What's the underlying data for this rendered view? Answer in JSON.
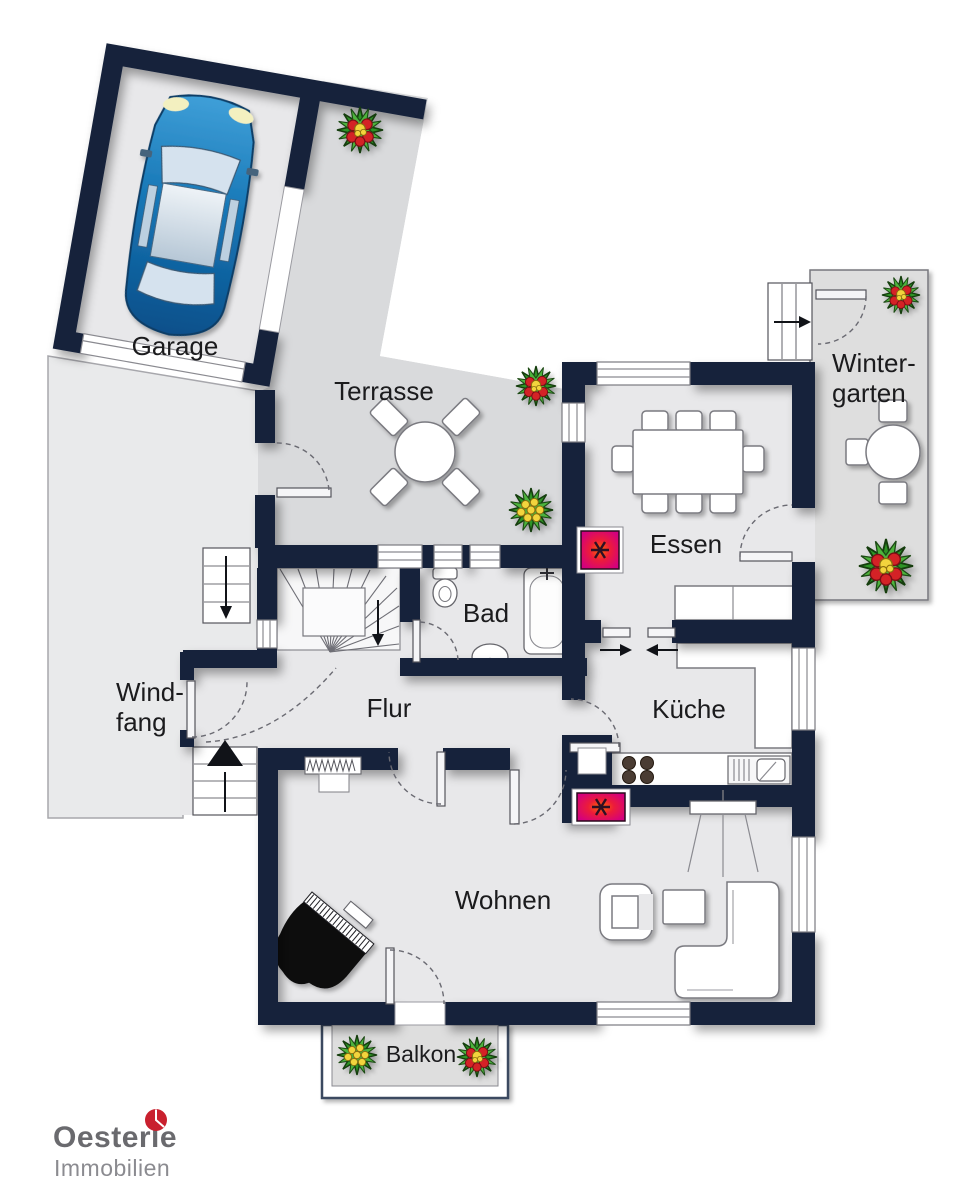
{
  "document": {
    "kind": "real-estate floor plan",
    "width_px": 968,
    "height_px": 1200
  },
  "rooms": [
    {
      "id": "garage",
      "label": "Garage"
    },
    {
      "id": "terrasse",
      "label": "Terrasse"
    },
    {
      "id": "wintergarten",
      "label_line1": "Winter-",
      "label_line2": "garten"
    },
    {
      "id": "essen",
      "label": "Essen"
    },
    {
      "id": "bad",
      "label": "Bad"
    },
    {
      "id": "flur",
      "label": "Flur"
    },
    {
      "id": "windfang",
      "label_line1": "Wind-",
      "label_line2": "fang"
    },
    {
      "id": "kueche",
      "label": "Küche"
    },
    {
      "id": "wohnen",
      "label": "Wohnen"
    },
    {
      "id": "balkon",
      "label": "Balkon"
    }
  ],
  "branding": {
    "company": "Oesterle",
    "division": "Immobilien",
    "accent_color": "#c9202e",
    "company_color": "#6a6a6e",
    "division_color": "#8b8b90"
  },
  "colors": {
    "wall": "#15233a",
    "interior_floor": "#e8e8ea",
    "outdoor_floor": "#d9dadc",
    "conservatory_floor": "#dedede",
    "driveway": "#e9eaeb",
    "fireplace_magenta": "#d4007e",
    "fireplace_glow": "#ff4d00",
    "car_blue": "#1273b8"
  },
  "icons": {
    "car-icon": "blue car seen from above in garage",
    "flower-icon": "red/yellow flower planter",
    "piano-icon": "black grand piano",
    "bathtub-icon": "bathtub",
    "toilet-icon": "toilet",
    "washbasin-icon": "wash basin",
    "stove-icon": "cooktop with 4 burners",
    "kitchen-sink-icon": "sink with drainboard",
    "fireplace-icon": "stove/fireplace symbol (magenta square with hatch)",
    "radiator-icon": "radiator",
    "stairs-icon": "winder staircase with direction arrow",
    "entrance-arrow-icon": "entrance direction arrow",
    "door-swing-icon": "dashed door swing arc",
    "dining-table-icon": "dining table with 8 chairs",
    "terrace-table-icon": "round table with 4 chairs",
    "conservatory-table-icon": "round table with 3 chairs",
    "sofa-icon": "L-shaped sofa",
    "armchair-icon": "armchair",
    "coffee-table-icon": "coffee table",
    "sideboard-icon": "sideboard",
    "pendant-lamp-icon": "hanging lamp over table"
  }
}
